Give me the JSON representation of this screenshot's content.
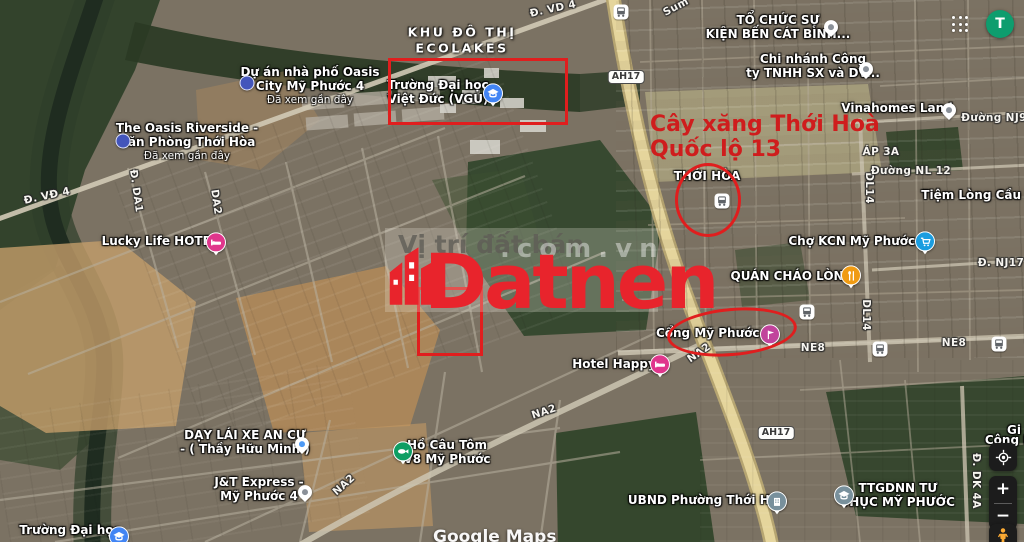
{
  "topbar": {
    "avatar_initial": "T"
  },
  "attribution": "Google Maps",
  "watermark": {
    "faded_line": "Vị trí đất bán",
    "faded_domain": ".com.vn",
    "brand": "Datnen"
  },
  "red_annotation": {
    "gas_line1": "Cây xăng Thới Hoà",
    "gas_line2": "Quốc lộ 13"
  },
  "area": {
    "ecolakes_l1": "KHU ĐÔ THỊ",
    "ecolakes_l2": "ECOLAKES"
  },
  "roads": {
    "vd4_top": "Đ. VD 4",
    "vd4_left": "Đ. VĐ 4",
    "da1": "Đ. DA1",
    "da2": "DA2",
    "ah17": "AH17",
    "na2": "NA2",
    "ne8": "NE8",
    "dl14": "DL14",
    "nj9": "Đường NJ9",
    "nl12": "Đường NL 12",
    "nj17": "Đ. NJ17",
    "dk4a": "Đ. DK 4A",
    "ap3a": "ÁP 3A",
    "sun_fragment": "Sum"
  },
  "pois": {
    "oasis_city": {
      "l1": "Dự án nhà phố Oasis",
      "l2": "City Mỹ Phước 4",
      "sub": "Đã xem gần đây"
    },
    "oasis_riverside": {
      "l1": "The Oasis Riverside -",
      "l2": "Văn Phòng Thới Hòa",
      "sub": "Đã xem gần đây"
    },
    "vgu": {
      "l1": "Trường Đại học",
      "l2": "Việt Đức (VGU)"
    },
    "lucky_life": {
      "l1": "Lucky Life HOTEL"
    },
    "thoi_hoa_stop": {
      "l1": "THỚI HÒA"
    },
    "to_chuc": {
      "l1": "TỔ CHỨC SỰ",
      "l2": "KIỆN BẾN CÁT BÌNH..."
    },
    "chi_nhanh": {
      "l1": "Chi nhánh Công",
      "l2": "ty TNHH SX và DV..."
    },
    "vinahomes": {
      "l1": "Vinahomes Land"
    },
    "tiem_long": {
      "l1": "Tiệm Lòng Cầu Út"
    },
    "cho_kcn": {
      "l1": "Chợ KCN Mỹ Phước 3"
    },
    "quan_chao": {
      "l1": "QUÁN CHÁO LÒNG"
    },
    "cong_mp3": {
      "l1": "Cổng Mỹ Phước 3"
    },
    "hotel_happy": {
      "l1": "Hotel Happy"
    },
    "day_lai_xe": {
      "l1": "DẠY LÁI XE AN CƯ",
      "l2": "- ( Thầy Hữu Minh )"
    },
    "jt_express": {
      "l1": "J&T Express -",
      "l2": "Mỹ Phước 4"
    },
    "ho_cau_tom": {
      "l1": "Hồ Câu Tôm",
      "l2": "V8 Mỹ Phước"
    },
    "ubnd": {
      "l1": "UBND Phường Thới Hoà"
    },
    "ttgdnn": {
      "l1": "TTGDNN TƯ",
      "l2": "THỤC MỸ PHƯỚC"
    },
    "truong_dh": {
      "l1": "Trường Đại học"
    },
    "gi_partial": {
      "l1": "Gi",
      "l2": "Cộng M"
    }
  },
  "controls": {
    "zoom_in_label": "+",
    "zoom_out_label": "−"
  },
  "colors": {
    "annotation_red": "#e01e1e",
    "brand_red": "#e8242c",
    "avatar_green": "#0e9d6e",
    "main_road_yellow": "#e5d59c",
    "hotel_pin": "#e0368c",
    "market_pin": "#1a9de0",
    "food_pin": "#f09b13",
    "attraction_pin": "#c1439c",
    "nature_pin": "#0d9e63",
    "civic_pin": "#78909c",
    "education_pin": "#4285f4"
  }
}
